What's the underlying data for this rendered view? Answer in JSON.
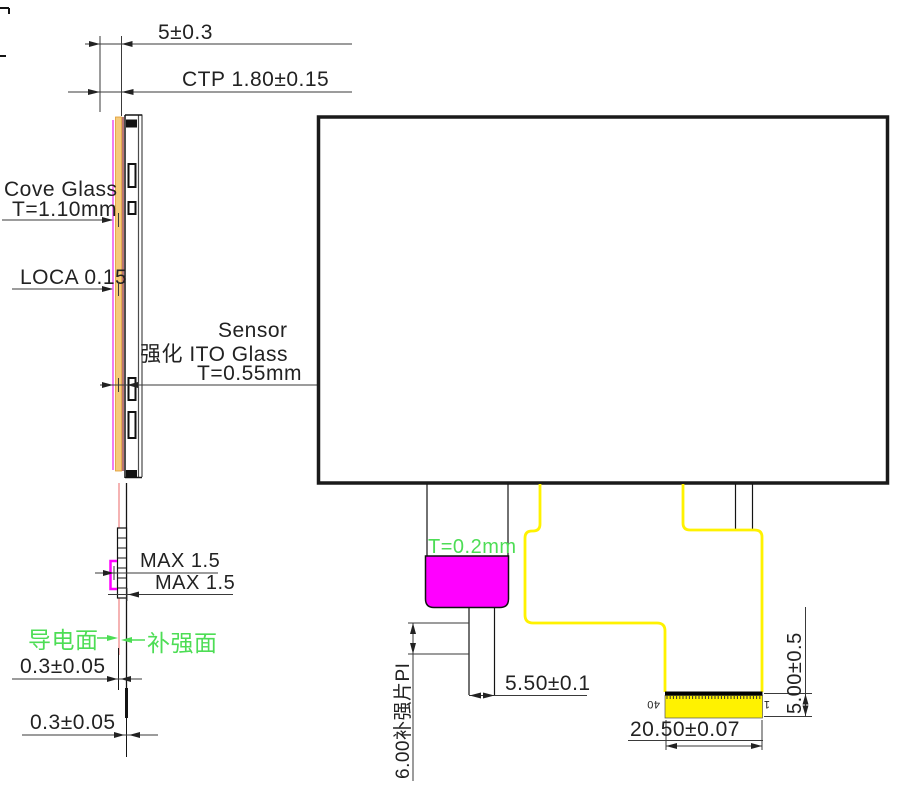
{
  "drawing_type": "touch-panel-engineering-drawing",
  "side_view": {
    "dim_overall": "5±0.3",
    "dim_ctp": "CTP 1.80±0.15",
    "cover_glass_name": "Cove Glass",
    "cover_glass_thickness": "T=1.10mm",
    "loca": "LOCA 0.15",
    "sensor_name": "Sensor",
    "sensor_material": "强化 ITO Glass",
    "sensor_thickness": "T=0.55mm",
    "fpc_max_upper": "MAX 1.5",
    "fpc_max_lower": "MAX 1.5",
    "conductive_face": "导电面",
    "stiffener_face": "补强面",
    "tail_dim_upper": "0.3±0.05",
    "tail_dim_lower": "0.3±0.05"
  },
  "front_view": {
    "stiffener_thickness": "T=0.2mm",
    "neck_width": "5.50±0.1",
    "stiffener_dim": "6.00补强片PI",
    "connector_width": "20.50±0.07",
    "connector_height": "5.00±0.5",
    "pin_first": "40",
    "pin_last": "1"
  },
  "colors": {
    "magenta": "#FF00FF",
    "violet_line": "#EE6FEE",
    "yellow": "#FFF200",
    "green": "#4DDD55",
    "orange_fill": "#F5CA7B",
    "orange_edge": "#DE9A30",
    "salmon": "#F29A9A",
    "dark_red": "#8B1A1A"
  }
}
